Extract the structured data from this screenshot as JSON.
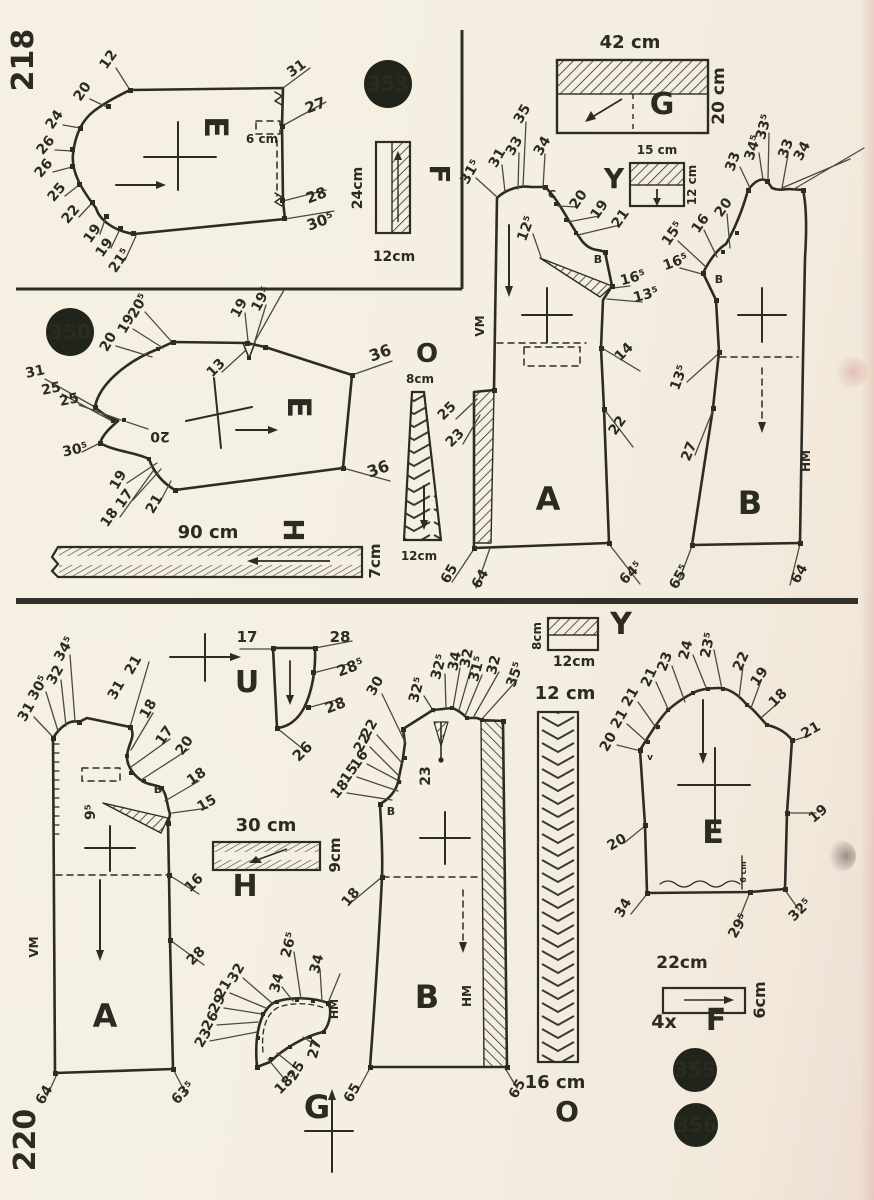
{
  "page": {
    "width": 874,
    "height": 1200,
    "bg_color": "#f4efe1",
    "ink_color": "#2d2c24",
    "badge_color": "#20241a",
    "page_number_top": "218",
    "page_number_bottom": "220"
  },
  "badges": [
    {
      "t": "353",
      "x": 388,
      "y": 84,
      "r": 24
    },
    {
      "t": "350",
      "x": 70,
      "y": 332,
      "r": 24
    },
    {
      "t": "355",
      "x": 695,
      "y": 1070,
      "r": 22
    },
    {
      "t": "356",
      "x": 696,
      "y": 1125,
      "r": 22
    }
  ],
  "labels": [
    {
      "t": "218",
      "x": 33,
      "y": 60,
      "r": -90,
      "s": 30,
      "w": 700,
      "n": "page-number-top"
    },
    {
      "t": "220",
      "x": 35,
      "y": 1140,
      "r": -90,
      "s": 30,
      "w": 700,
      "n": "page-number-bottom"
    },
    {
      "t": "12",
      "x": 112,
      "y": 62,
      "r": -55
    },
    {
      "t": "20",
      "x": 86,
      "y": 94,
      "r": -55
    },
    {
      "t": "24",
      "x": 58,
      "y": 122,
      "r": -55
    },
    {
      "t": "26",
      "x": 49,
      "y": 148,
      "r": -50
    },
    {
      "t": "26",
      "x": 47,
      "y": 171,
      "r": -50
    },
    {
      "t": "25",
      "x": 60,
      "y": 195,
      "r": -50
    },
    {
      "t": "22",
      "x": 74,
      "y": 217,
      "r": -50
    },
    {
      "t": "19",
      "x": 96,
      "y": 236,
      "r": -55
    },
    {
      "t": "19",
      "x": 108,
      "y": 250,
      "r": -55
    },
    {
      "t": "21⁵",
      "x": 123,
      "y": 263,
      "r": -55
    },
    {
      "t": "31",
      "x": 299,
      "y": 72,
      "r": -35
    },
    {
      "t": "27",
      "x": 317,
      "y": 110,
      "r": -20,
      "s": 15
    },
    {
      "t": "6 cm",
      "x": 262,
      "y": 143,
      "s": 12,
      "n": "dimension-label"
    },
    {
      "t": "28",
      "x": 318,
      "y": 200,
      "r": -20,
      "s": 15
    },
    {
      "t": "30⁵",
      "x": 322,
      "y": 226,
      "r": -20,
      "s": 15
    },
    {
      "t": "E",
      "x": 205,
      "y": 127,
      "r": 90,
      "s": 32,
      "w": 700,
      "n": "piece-letter"
    },
    {
      "t": "24cm",
      "x": 362,
      "y": 188,
      "r": -90,
      "s": 14,
      "n": "dimension-label"
    },
    {
      "t": "12cm",
      "x": 394,
      "y": 261,
      "s": 14,
      "n": "dimension-label"
    },
    {
      "t": "F",
      "x": 430,
      "y": 174,
      "r": 90,
      "s": 28,
      "w": 700,
      "n": "piece-letter"
    },
    {
      "t": "42 cm",
      "x": 630,
      "y": 48,
      "s": 18,
      "n": "dimension-label"
    },
    {
      "t": "20 cm",
      "x": 724,
      "y": 96,
      "r": -90,
      "s": 17,
      "n": "dimension-label"
    },
    {
      "t": "G",
      "x": 662,
      "y": 114,
      "s": 30,
      "w": 700,
      "n": "piece-letter"
    },
    {
      "t": "15 cm",
      "x": 657,
      "y": 154,
      "s": 12,
      "n": "dimension-label"
    },
    {
      "t": "12 cm",
      "x": 696,
      "y": 185,
      "r": -90,
      "s": 12,
      "n": "dimension-label"
    },
    {
      "t": "Y",
      "x": 614,
      "y": 188,
      "s": 28,
      "w": 700,
      "n": "piece-letter"
    },
    {
      "t": "31⁵",
      "x": 474,
      "y": 174,
      "r": -60
    },
    {
      "t": "31",
      "x": 501,
      "y": 160,
      "r": -60
    },
    {
      "t": "33",
      "x": 518,
      "y": 148,
      "r": -60
    },
    {
      "t": "35",
      "x": 526,
      "y": 116,
      "r": -60
    },
    {
      "t": "34",
      "x": 546,
      "y": 148,
      "r": -60
    },
    {
      "t": "C",
      "x": 552,
      "y": 198,
      "s": 11,
      "n": "notch-letter"
    },
    {
      "t": "20",
      "x": 582,
      "y": 202,
      "r": -55
    },
    {
      "t": "19",
      "x": 603,
      "y": 212,
      "r": -55
    },
    {
      "t": "21",
      "x": 624,
      "y": 221,
      "r": -55
    },
    {
      "t": "12⁵",
      "x": 530,
      "y": 230,
      "r": -70
    },
    {
      "t": "B",
      "x": 598,
      "y": 263,
      "s": 11,
      "n": "notch-letter"
    },
    {
      "t": "16⁵",
      "x": 634,
      "y": 282,
      "r": -15
    },
    {
      "t": "13⁵",
      "x": 647,
      "y": 299,
      "r": -15
    },
    {
      "t": "14",
      "x": 627,
      "y": 355,
      "r": -45
    },
    {
      "t": "22",
      "x": 621,
      "y": 428,
      "r": -55
    },
    {
      "t": "25",
      "x": 450,
      "y": 414,
      "r": -45
    },
    {
      "t": "23",
      "x": 458,
      "y": 441,
      "r": -45
    },
    {
      "t": "VM",
      "x": 484,
      "y": 326,
      "r": -90,
      "s": 12,
      "n": "seam-label"
    },
    {
      "t": "A",
      "x": 548,
      "y": 510,
      "s": 32,
      "w": 700,
      "n": "piece-letter"
    },
    {
      "t": "65",
      "x": 453,
      "y": 576,
      "r": -60
    },
    {
      "t": "64",
      "x": 484,
      "y": 581,
      "r": -60
    },
    {
      "t": "64⁵",
      "x": 634,
      "y": 576,
      "r": -45
    },
    {
      "t": "33",
      "x": 737,
      "y": 163,
      "r": -70
    },
    {
      "t": "34⁵",
      "x": 757,
      "y": 149,
      "r": -72
    },
    {
      "t": "33⁵",
      "x": 768,
      "y": 128,
      "r": -75
    },
    {
      "t": "33",
      "x": 790,
      "y": 150,
      "r": -70
    },
    {
      "t": "34",
      "x": 806,
      "y": 153,
      "r": -62
    },
    {
      "t": "20",
      "x": 727,
      "y": 210,
      "r": -55
    },
    {
      "t": "16",
      "x": 704,
      "y": 226,
      "r": -55
    },
    {
      "t": "15⁵",
      "x": 676,
      "y": 236,
      "r": -55
    },
    {
      "t": "16⁵",
      "x": 677,
      "y": 266,
      "r": -20
    },
    {
      "t": "B",
      "x": 719,
      "y": 283,
      "s": 11,
      "n": "notch-letter"
    },
    {
      "t": "13⁵",
      "x": 683,
      "y": 379,
      "r": -70
    },
    {
      "t": "27",
      "x": 693,
      "y": 453,
      "r": -68
    },
    {
      "t": "HM",
      "x": 810,
      "y": 461,
      "r": -90,
      "s": 12,
      "n": "seam-label"
    },
    {
      "t": "B",
      "x": 750,
      "y": 514,
      "s": 32,
      "w": 700,
      "n": "piece-letter"
    },
    {
      "t": "65⁵",
      "x": 683,
      "y": 579,
      "r": -60
    },
    {
      "t": "64",
      "x": 803,
      "y": 576,
      "r": -60
    },
    {
      "t": "20⁵",
      "x": 142,
      "y": 308,
      "r": -60
    },
    {
      "t": "19",
      "x": 130,
      "y": 326,
      "r": -60
    },
    {
      "t": "20",
      "x": 112,
      "y": 344,
      "r": -60
    },
    {
      "t": "19",
      "x": 243,
      "y": 310,
      "r": -62
    },
    {
      "t": "19⁵",
      "x": 265,
      "y": 301,
      "r": -62
    },
    {
      "t": "13",
      "x": 219,
      "y": 371,
      "r": -45
    },
    {
      "t": "36",
      "x": 382,
      "y": 358,
      "r": -20,
      "s": 16
    },
    {
      "t": "36",
      "x": 380,
      "y": 474,
      "r": -20,
      "s": 16
    },
    {
      "t": "31",
      "x": 36,
      "y": 376,
      "r": -12
    },
    {
      "t": "25",
      "x": 52,
      "y": 393,
      "r": -12
    },
    {
      "t": "25",
      "x": 70,
      "y": 404,
      "r": -12
    },
    {
      "t": "30⁵",
      "x": 76,
      "y": 454,
      "r": -12
    },
    {
      "t": "20",
      "x": 160,
      "y": 432,
      "r": 180
    },
    {
      "t": "19",
      "x": 122,
      "y": 482,
      "r": -60
    },
    {
      "t": "17",
      "x": 128,
      "y": 501,
      "r": -55
    },
    {
      "t": "21",
      "x": 158,
      "y": 506,
      "r": -60
    },
    {
      "t": "18",
      "x": 113,
      "y": 520,
      "r": -55
    },
    {
      "t": "E",
      "x": 288,
      "y": 407,
      "r": 90,
      "s": 32,
      "w": 700,
      "n": "piece-letter"
    },
    {
      "t": "90 cm",
      "x": 208,
      "y": 538,
      "s": 18,
      "n": "dimension-label"
    },
    {
      "t": "H",
      "x": 284,
      "y": 530,
      "r": 90,
      "s": 28,
      "w": 700,
      "n": "piece-letter"
    },
    {
      "t": "7cm",
      "x": 380,
      "y": 561,
      "r": -90,
      "s": 15,
      "n": "dimension-label"
    },
    {
      "t": "O",
      "x": 427,
      "y": 362,
      "s": 26,
      "w": 700,
      "n": "piece-letter"
    },
    {
      "t": "8cm",
      "x": 420,
      "y": 383,
      "s": 12,
      "n": "dimension-label"
    },
    {
      "t": "12cm",
      "x": 419,
      "y": 560,
      "s": 12,
      "n": "dimension-label"
    },
    {
      "t": "31",
      "x": 30,
      "y": 714,
      "r": -60
    },
    {
      "t": "30⁵",
      "x": 42,
      "y": 690,
      "r": -60
    },
    {
      "t": "32",
      "x": 59,
      "y": 677,
      "r": -60
    },
    {
      "t": "34⁵",
      "x": 68,
      "y": 651,
      "r": -60
    },
    {
      "t": "31",
      "x": 120,
      "y": 692,
      "r": -60
    },
    {
      "t": "21",
      "x": 137,
      "y": 667,
      "r": -60
    },
    {
      "t": "18",
      "x": 152,
      "y": 711,
      "r": -60
    },
    {
      "t": "17",
      "x": 168,
      "y": 738,
      "r": -55
    },
    {
      "t": "20",
      "x": 188,
      "y": 748,
      "r": -55
    },
    {
      "t": "18",
      "x": 199,
      "y": 780,
      "r": -35
    },
    {
      "t": "15",
      "x": 209,
      "y": 807,
      "r": -30
    },
    {
      "t": "B",
      "x": 158,
      "y": 793,
      "s": 11,
      "n": "notch-letter"
    },
    {
      "t": "9⁵",
      "x": 95,
      "y": 812,
      "r": -90
    },
    {
      "t": "16",
      "x": 197,
      "y": 886,
      "r": -45
    },
    {
      "t": "28",
      "x": 199,
      "y": 959,
      "r": -45
    },
    {
      "t": "VM",
      "x": 38,
      "y": 947,
      "r": -90,
      "s": 12,
      "n": "seam-label"
    },
    {
      "t": "A",
      "x": 105,
      "y": 1027,
      "s": 32,
      "w": 700,
      "n": "piece-letter"
    },
    {
      "t": "64",
      "x": 48,
      "y": 1097,
      "r": -60
    },
    {
      "t": "63⁵",
      "x": 186,
      "y": 1096,
      "r": -45
    },
    {
      "t": "17",
      "x": 247,
      "y": 642,
      "s": 15
    },
    {
      "t": "28",
      "x": 340,
      "y": 642,
      "s": 15
    },
    {
      "t": "28⁵",
      "x": 352,
      "y": 672,
      "r": -20,
      "s": 15
    },
    {
      "t": "28",
      "x": 337,
      "y": 710,
      "r": -20,
      "s": 15
    },
    {
      "t": "26",
      "x": 306,
      "y": 755,
      "r": -45,
      "s": 15
    },
    {
      "t": "U",
      "x": 247,
      "y": 692,
      "s": 30,
      "w": 700,
      "n": "piece-letter"
    },
    {
      "t": "30 cm",
      "x": 266,
      "y": 831,
      "s": 18,
      "n": "dimension-label"
    },
    {
      "t": "9cm",
      "x": 340,
      "y": 855,
      "r": -90,
      "s": 15,
      "n": "dimension-label"
    },
    {
      "t": "H",
      "x": 245,
      "y": 896,
      "s": 30,
      "w": 700,
      "n": "piece-letter"
    },
    {
      "t": "30",
      "x": 379,
      "y": 688,
      "r": -60
    },
    {
      "t": "22",
      "x": 373,
      "y": 731,
      "r": -60
    },
    {
      "t": "22",
      "x": 366,
      "y": 745,
      "r": -60
    },
    {
      "t": "16",
      "x": 363,
      "y": 762,
      "r": -55
    },
    {
      "t": "15",
      "x": 353,
      "y": 776,
      "r": -55
    },
    {
      "t": "18",
      "x": 343,
      "y": 792,
      "r": -50
    },
    {
      "t": "32⁵",
      "x": 421,
      "y": 691,
      "r": -75
    },
    {
      "t": "32⁵",
      "x": 443,
      "y": 668,
      "r": -75
    },
    {
      "t": "34",
      "x": 459,
      "y": 662,
      "r": -78
    },
    {
      "t": "32",
      "x": 471,
      "y": 659,
      "r": -78
    },
    {
      "t": "31⁵",
      "x": 481,
      "y": 670,
      "r": -75
    },
    {
      "t": "32",
      "x": 498,
      "y": 666,
      "r": -75
    },
    {
      "t": "35⁵",
      "x": 519,
      "y": 676,
      "r": -70
    },
    {
      "t": "23",
      "x": 430,
      "y": 776,
      "r": -90
    },
    {
      "t": "B",
      "x": 391,
      "y": 815,
      "s": 11,
      "n": "notch-letter"
    },
    {
      "t": "18",
      "x": 354,
      "y": 900,
      "r": -50
    },
    {
      "t": "B",
      "x": 427,
      "y": 1008,
      "s": 32,
      "w": 700,
      "n": "piece-letter"
    },
    {
      "t": "HM",
      "x": 471,
      "y": 996,
      "r": -90,
      "s": 12,
      "n": "seam-label"
    },
    {
      "t": "65",
      "x": 356,
      "y": 1095,
      "r": -60
    },
    {
      "t": "65",
      "x": 521,
      "y": 1091,
      "r": -60
    },
    {
      "t": "8cm",
      "x": 541,
      "y": 636,
      "r": -90,
      "s": 12,
      "n": "dimension-label"
    },
    {
      "t": "12cm",
      "x": 574,
      "y": 666,
      "s": 14,
      "n": "dimension-label"
    },
    {
      "t": "Y",
      "x": 621,
      "y": 634,
      "s": 30,
      "w": 700,
      "n": "piece-letter"
    },
    {
      "t": "12 cm",
      "x": 565,
      "y": 699,
      "s": 18,
      "n": "dimension-label"
    },
    {
      "t": "16 cm",
      "x": 555,
      "y": 1088,
      "s": 18,
      "n": "dimension-label"
    },
    {
      "t": "O",
      "x": 567,
      "y": 1121,
      "s": 28,
      "w": 700,
      "n": "piece-letter"
    },
    {
      "t": "32",
      "x": 240,
      "y": 975,
      "r": -60
    },
    {
      "t": "21",
      "x": 227,
      "y": 991,
      "r": -60
    },
    {
      "t": "29",
      "x": 221,
      "y": 1006,
      "r": -60
    },
    {
      "t": "26",
      "x": 214,
      "y": 1023,
      "r": -60
    },
    {
      "t": "23",
      "x": 207,
      "y": 1040,
      "r": -60
    },
    {
      "t": "18⁵",
      "x": 289,
      "y": 1086,
      "r": -45
    },
    {
      "t": "25",
      "x": 300,
      "y": 1073,
      "r": -60
    },
    {
      "t": "27",
      "x": 319,
      "y": 1050,
      "r": -75
    },
    {
      "t": "34",
      "x": 281,
      "y": 984,
      "r": -75
    },
    {
      "t": "26⁵",
      "x": 293,
      "y": 946,
      "r": -75
    },
    {
      "t": "34",
      "x": 321,
      "y": 965,
      "r": -75
    },
    {
      "t": "HM",
      "x": 338,
      "y": 1009,
      "r": -90,
      "s": 11,
      "n": "seam-label"
    },
    {
      "t": "G",
      "x": 317,
      "y": 1118,
      "s": 32,
      "w": 700,
      "n": "piece-letter"
    },
    {
      "t": "20",
      "x": 612,
      "y": 744,
      "r": -60
    },
    {
      "t": "21",
      "x": 623,
      "y": 721,
      "r": -60
    },
    {
      "t": "21",
      "x": 634,
      "y": 699,
      "r": -60
    },
    {
      "t": "21",
      "x": 653,
      "y": 679,
      "r": -65
    },
    {
      "t": "23",
      "x": 669,
      "y": 663,
      "r": -70
    },
    {
      "t": "24",
      "x": 690,
      "y": 651,
      "r": -75
    },
    {
      "t": "23⁵",
      "x": 712,
      "y": 646,
      "r": -78
    },
    {
      "t": "22",
      "x": 745,
      "y": 663,
      "r": -65
    },
    {
      "t": "19",
      "x": 763,
      "y": 679,
      "r": -55
    },
    {
      "t": "18",
      "x": 781,
      "y": 701,
      "r": -45
    },
    {
      "t": "21",
      "x": 813,
      "y": 734,
      "r": -30
    },
    {
      "t": "19",
      "x": 821,
      "y": 817,
      "r": -40
    },
    {
      "t": "20",
      "x": 619,
      "y": 846,
      "r": -30
    },
    {
      "t": "34",
      "x": 627,
      "y": 910,
      "r": -60
    },
    {
      "t": "29⁵",
      "x": 742,
      "y": 928,
      "r": -60
    },
    {
      "t": "32⁵",
      "x": 803,
      "y": 913,
      "r": -45
    },
    {
      "t": "v",
      "x": 650,
      "y": 760,
      "s": 9,
      "n": "notch-letter"
    },
    {
      "t": "6 cm",
      "x": 746,
      "y": 872,
      "r": -90,
      "s": 8,
      "n": "dimension-label"
    },
    {
      "t": "E",
      "x": 713,
      "y": 843,
      "s": 32,
      "w": 700,
      "n": "piece-letter"
    },
    {
      "t": "22cm",
      "x": 682,
      "y": 968,
      "s": 17,
      "n": "dimension-label"
    },
    {
      "t": "6cm",
      "x": 765,
      "y": 1000,
      "r": -90,
      "s": 16,
      "n": "dimension-label"
    },
    {
      "t": "4x",
      "x": 664,
      "y": 1028,
      "s": 19,
      "n": "quantity-label"
    },
    {
      "t": "F",
      "x": 716,
      "y": 1030,
      "s": 30,
      "w": 700,
      "n": "piece-letter"
    }
  ]
}
